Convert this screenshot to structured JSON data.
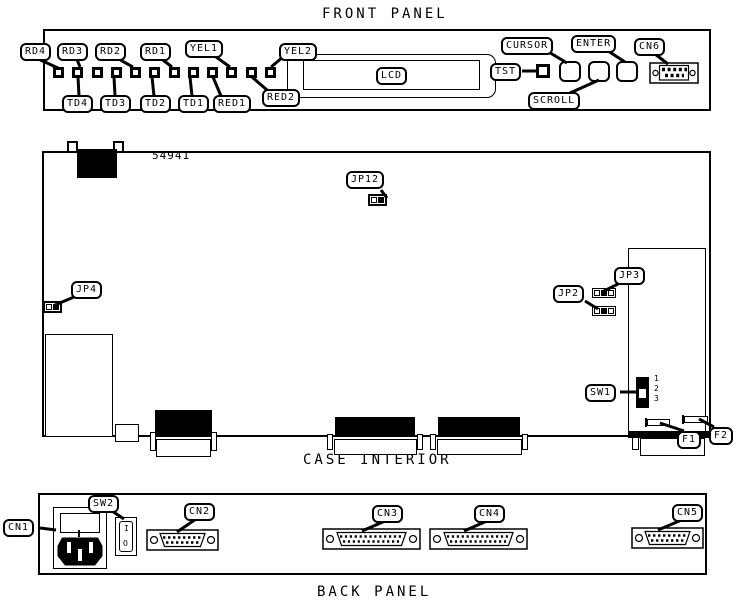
{
  "titles": {
    "front": "FRONT PANEL",
    "case": "CASE INTERIOR",
    "back": "BACK PANEL"
  },
  "front_panel": {
    "led_labels_top": [
      "RD4",
      "RD3",
      "RD2",
      "RD1",
      "YEL1",
      "YEL2"
    ],
    "led_labels_bottom": [
      "TD4",
      "TD3",
      "TD2",
      "TD1",
      "RED1",
      "RED2"
    ],
    "led_order": [
      "RD4",
      "TD4",
      "RD3",
      "TD3",
      "RD2",
      "TD2",
      "RD1",
      "TD1",
      "RED1",
      "YEL1",
      "RED2",
      "YEL2"
    ],
    "lcd": "LCD",
    "tst": "TST",
    "cursor": "CURSOR",
    "enter": "ENTER",
    "scroll": "SCROLL",
    "cn6": "CN6"
  },
  "case_interior": {
    "board_number": "54941",
    "jp12": "JP12",
    "jp4": "JP4",
    "jp2": "JP2",
    "jp3": "JP3",
    "sw1": "SW1",
    "dip_positions": [
      "1",
      "2",
      "3"
    ],
    "f1": "F1",
    "f2": "F2"
  },
  "back_panel": {
    "cn1": "CN1",
    "sw2": "SW2",
    "cn2": "CN2",
    "cn3": "CN3",
    "cn4": "CN4",
    "cn5": "CN5",
    "switch_on": "I",
    "switch_off": "O"
  },
  "colors": {
    "ink": "#000000",
    "background": "#ffffff"
  }
}
